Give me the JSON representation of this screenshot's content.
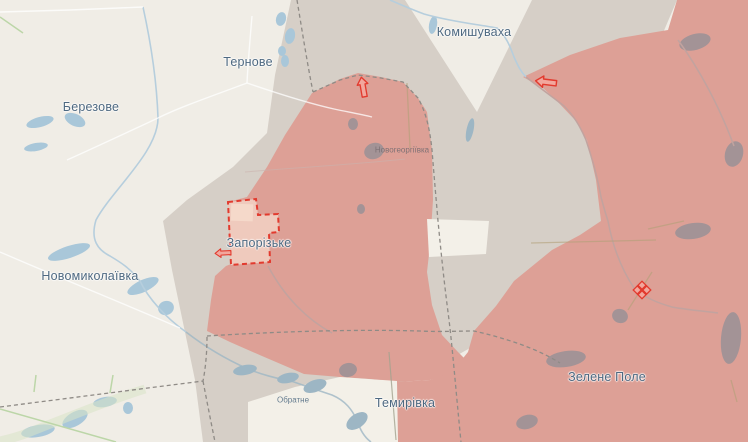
{
  "map": {
    "labels": {
      "ternove": "Тернове",
      "komyshuvakha": "Комишуваха",
      "berezove": "Березове",
      "novomykolaivka": "Новомиколаївка",
      "zaporizke": "Запорізьке",
      "novoheorhiivka": "Новогеоргіївка",
      "temyrivka": "Темирівка",
      "zelene_pole": "Зелене Поле",
      "obratne": "Обратне"
    },
    "icons": {
      "arrow_north": "attack-direction-arrow",
      "arrow_komyshuvakha": "attack-direction-arrow",
      "arrow_zaporizke": "attack-direction-arrow",
      "diamond_zelene_pole": "clash-diamond-marker"
    },
    "colors": {
      "base_land": "#f0ede6",
      "field_light": "#f3f0e8",
      "grey_zone": "#d6cfc7",
      "occupied": "#dda096",
      "pocket_fill": "#efcabd",
      "pocket_inner": "#f5d9ca",
      "red_line": "#e23a2e",
      "arrow_fill": "#f2a79d",
      "water": "#a9c7d9",
      "water_muted": "#9db6c4",
      "stream": "#b6cedd",
      "blob_in_red": "#a39396",
      "stream_in_red": "#c2a39f",
      "road": "#ffffff",
      "green_line": "#bcd6a8",
      "khaki": "#b3a078",
      "admin_dash": "#8f8b86",
      "label_text": "#4e6981",
      "label_muted": "#7b6f73"
    }
  }
}
